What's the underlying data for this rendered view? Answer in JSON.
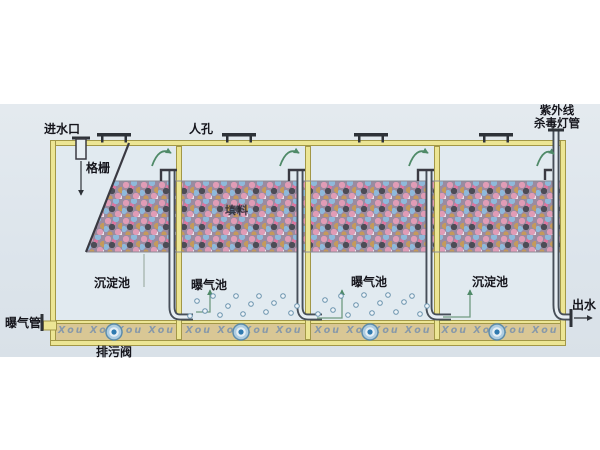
{
  "diagram": {
    "type": "wastewater-treatment-tank-schematic",
    "labels": {
      "inlet": "进水口",
      "manhole": "人孔",
      "bar_screen": "格栅",
      "media": "填料",
      "aeration_pipe": "曝气管",
      "drain_valve": "排污阀",
      "outlet": "出水",
      "uv_lamp_line1": "紫外线",
      "uv_lamp_line2": "杀毒灯管"
    },
    "chambers": [
      {
        "label": "沉淀池"
      },
      {
        "label": "曝气池"
      },
      {
        "label": "曝气池"
      },
      {
        "label": "沉淀池"
      }
    ],
    "watermark_text": "Xou XouXou Xou",
    "colors": {
      "tank_wall": "#ece594",
      "wall_border": "#a29747",
      "water": "#e1eaf0",
      "background": "#dde5ec",
      "channel_fill": "#d9c795",
      "pipe": "#474f59",
      "flow_arrow": "#4f8a68",
      "diffuser_blue": "#2f7ab0",
      "media_pink": "#e09cb6",
      "media_blue": "#8fb9da",
      "media_tan": "#c49a5c",
      "media_dark": "#4c4c56"
    }
  }
}
